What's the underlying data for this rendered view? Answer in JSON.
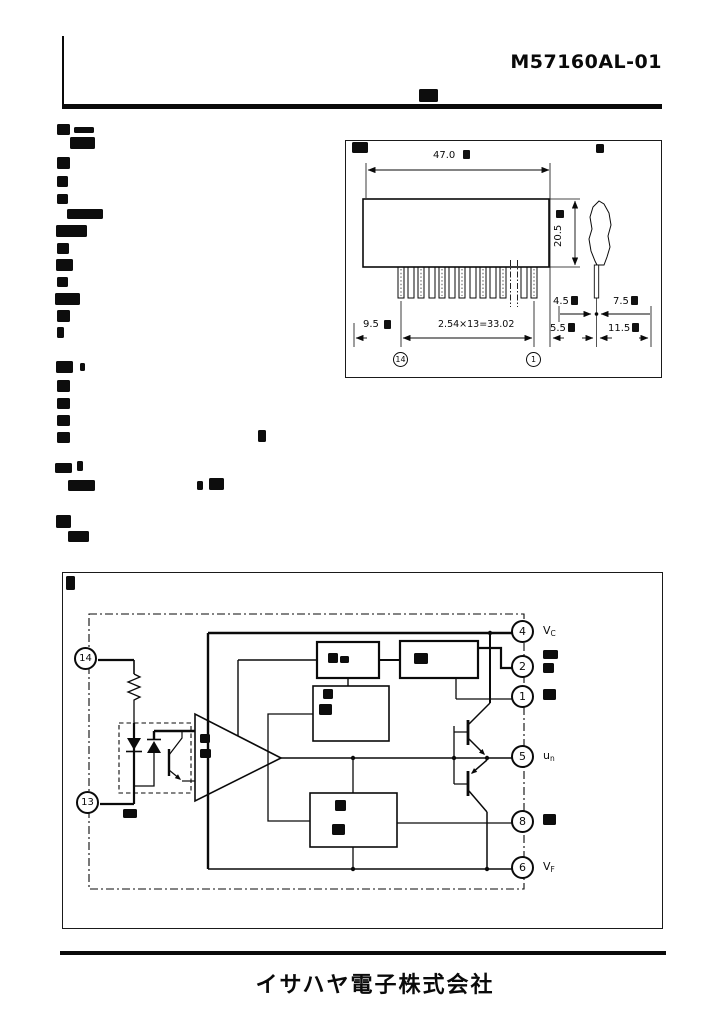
{
  "header": {
    "part_number": "M57160AL-01"
  },
  "package": {
    "dims": {
      "body_width": "47.0",
      "body_height": "20.5",
      "edge_to_pin1": "9.5",
      "pin_pitch_total": "2.54×13=33.02",
      "lead_front": "4.5",
      "lead_rear": "7.5",
      "lead_low_front": "5.5",
      "lead_low_rear": "11.5"
    },
    "pin_callout_left": "14",
    "pin_callout_right": "1"
  },
  "diagram": {
    "pin4": "4",
    "pin2": "2",
    "pin1": "1",
    "pin5": "5",
    "pin8": "8",
    "pin6": "6",
    "pin14": "14",
    "pin13": "13",
    "labels": {
      "vc_base": "V",
      "vc_sub": "C",
      "un_base": "u",
      "un_sub": "n",
      "vf_base": "V",
      "vf_sub": "F"
    }
  },
  "footer": {
    "company": "イサハヤ電子株式会社"
  }
}
